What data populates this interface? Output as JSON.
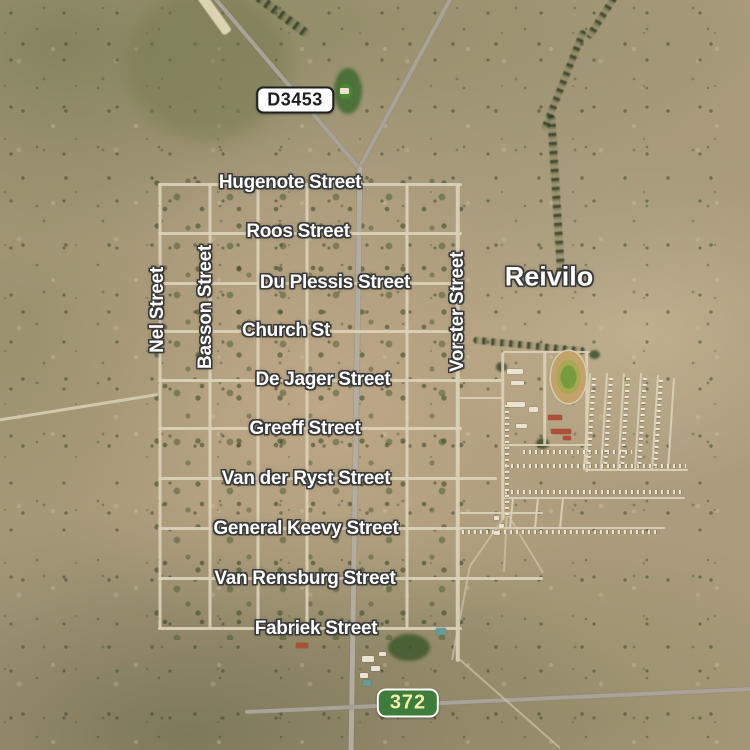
{
  "app": {
    "type": "satellite-map-view",
    "place_shown": "Reivilo"
  },
  "map": {
    "town_label": {
      "text": "Reivilo",
      "x": 549,
      "y": 277
    },
    "route_badges": [
      {
        "text": "D3453",
        "kind": "provincial",
        "x": 295,
        "y": 100
      },
      {
        "text": "372",
        "kind": "regional",
        "x": 408,
        "y": 703
      }
    ],
    "street_labels": {
      "horizontal": [
        {
          "text": "Hugenote Street",
          "x": 290,
          "y": 183
        },
        {
          "text": "Roos Street",
          "x": 298,
          "y": 232
        },
        {
          "text": "Du Plessis Street",
          "x": 335,
          "y": 283
        },
        {
          "text": "Church St",
          "x": 286,
          "y": 331
        },
        {
          "text": "De Jager Street",
          "x": 323,
          "y": 380
        },
        {
          "text": "Greeff Street",
          "x": 305,
          "y": 429
        },
        {
          "text": "Van der Ryst Street",
          "x": 306,
          "y": 479
        },
        {
          "text": "General Keevy Street",
          "x": 306,
          "y": 529
        },
        {
          "text": "Van Rensburg Street",
          "x": 305,
          "y": 579
        },
        {
          "text": "Fabriek Street",
          "x": 316,
          "y": 629
        }
      ],
      "vertical": [
        {
          "text": "Nel Street",
          "x": 158,
          "y": 310
        },
        {
          "text": "Basson Street",
          "x": 206,
          "y": 307
        },
        {
          "text": "Vorster Street",
          "x": 458,
          "y": 312
        }
      ]
    },
    "colors": {
      "label_text": "#ffffff",
      "label_outline": "#383838",
      "provincial_badge_bg": "#ffffff",
      "provincial_badge_text": "#1f1f1f",
      "regional_badge_bg": "#3d7c3b",
      "regional_badge_text": "#f3eda8",
      "regional_badge_border": "#ffffff"
    }
  }
}
